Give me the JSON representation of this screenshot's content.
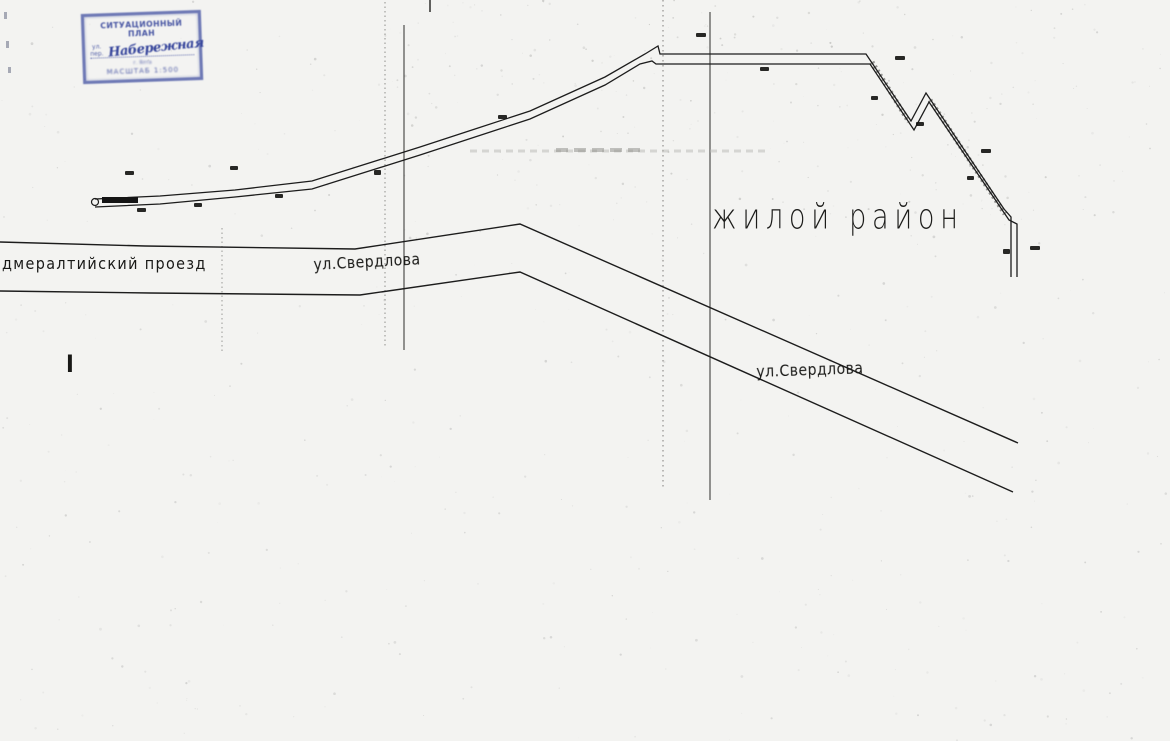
{
  "colors": {
    "paper": "#f3f3f1",
    "ink": "#1c1c1c",
    "stamp_ink": "#35449b",
    "guide_gray": "#8f8f8c"
  },
  "stamp": {
    "title": "СИТУАЦИОННЫЙ ПЛАН",
    "prefix": "ул. пер.",
    "handwritten": "Набережная",
    "line3": "г. Ялта",
    "scale": "МАСШТАБ 1:500"
  },
  "map": {
    "labels": {
      "proyezd": {
        "text": "дмералтийский проезд"
      },
      "sverdlova_upper": {
        "text": "ул.Свердлова"
      },
      "district": {
        "text": "жилой район"
      },
      "sverdlova_lower": {
        "text": "ул.Свердлова"
      },
      "section_mark": {
        "text": "I"
      }
    },
    "roads": {
      "top": [
        [
          0,
          242
        ],
        [
          145,
          246
        ],
        [
          355,
          249
        ],
        [
          520,
          224
        ],
        [
          1018,
          443
        ]
      ],
      "bottom": [
        [
          0,
          291
        ],
        [
          150,
          293
        ],
        [
          360,
          295
        ],
        [
          520,
          272
        ],
        [
          1013,
          492
        ]
      ]
    },
    "pipeline": {
      "upper": [
        [
          95,
          199
        ],
        [
          160,
          196
        ],
        [
          235,
          190
        ],
        [
          312,
          181
        ],
        [
          420,
          147
        ],
        [
          530,
          111
        ],
        [
          605,
          77
        ],
        [
          645,
          54
        ],
        [
          658,
          46
        ],
        [
          660,
          54
        ],
        [
          866,
          54
        ],
        [
          911,
          121
        ],
        [
          926,
          93
        ],
        [
          1004,
          209
        ],
        [
          1011,
          217
        ],
        [
          1011,
          277
        ]
      ],
      "lower": [
        [
          95,
          207
        ],
        [
          160,
          204
        ],
        [
          235,
          197
        ],
        [
          312,
          189
        ],
        [
          420,
          155
        ],
        [
          530,
          119
        ],
        [
          605,
          85
        ],
        [
          640,
          64
        ],
        [
          652,
          61
        ],
        [
          656,
          64
        ],
        [
          870,
          64
        ],
        [
          914,
          130
        ],
        [
          929,
          102
        ],
        [
          1009,
          220
        ],
        [
          1017,
          224
        ],
        [
          1017,
          277
        ]
      ],
      "start_bar": [
        102,
        197,
        36,
        6
      ],
      "start_circle": [
        95,
        202,
        3.5
      ],
      "hatch": [
        [
          [
            872,
            62
          ],
          [
            909,
            122
          ]
        ],
        [
          [
            930,
            100
          ],
          [
            1005,
            214
          ]
        ]
      ]
    },
    "guides": {
      "verticals": [
        {
          "x": 222,
          "y1": 228,
          "y2": 352,
          "dash": "1.5 3",
          "color": "#9a9a97",
          "w": 1
        },
        {
          "x": 385,
          "y1": 2,
          "y2": 346,
          "dash": "1.5 3",
          "color": "#8f8f8c",
          "w": 1
        },
        {
          "x": 404,
          "y1": 25,
          "y2": 350,
          "dash": "",
          "color": "#2e2e2c",
          "w": 1
        },
        {
          "x": 430,
          "y1": 0,
          "y2": 12,
          "dash": "",
          "color": "#2e2e2c",
          "w": 1.5
        },
        {
          "x": 663,
          "y1": 0,
          "y2": 488,
          "dash": "1.5 3.5",
          "color": "#93908e",
          "w": 1.2
        },
        {
          "x": 710,
          "y1": 12,
          "y2": 500,
          "dash": "",
          "color": "#2e2e2c",
          "w": 1
        }
      ],
      "horizontals": [
        {
          "x1": 470,
          "x2": 768,
          "y": 151,
          "color": "#b9b9b5",
          "w": 3,
          "dash": "7 5",
          "o": 0.5
        },
        {
          "x1": 556,
          "x2": 644,
          "y": 150,
          "color": "#8c8c88",
          "w": 4,
          "dash": "12 6",
          "o": 0.5
        }
      ]
    },
    "marks": [
      [
        125,
        171,
        9,
        4
      ],
      [
        230,
        166,
        8,
        4
      ],
      [
        137,
        208,
        9,
        4
      ],
      [
        194,
        203,
        8,
        4
      ],
      [
        275,
        194,
        8,
        4
      ],
      [
        374,
        170,
        7,
        5
      ],
      [
        498,
        115,
        9,
        4
      ],
      [
        696,
        33,
        10,
        4
      ],
      [
        760,
        67,
        9,
        4
      ],
      [
        895,
        56,
        10,
        4
      ],
      [
        871,
        96,
        7,
        4
      ],
      [
        916,
        122,
        8,
        4
      ],
      [
        981,
        149,
        10,
        4
      ],
      [
        967,
        176,
        7,
        4
      ],
      [
        1003,
        249,
        7,
        5
      ],
      [
        1030,
        246,
        10,
        4
      ]
    ],
    "edge_marks": [
      [
        4,
        12,
        3,
        7
      ],
      [
        6,
        41,
        3,
        7
      ],
      [
        8,
        67,
        3,
        6
      ]
    ]
  }
}
